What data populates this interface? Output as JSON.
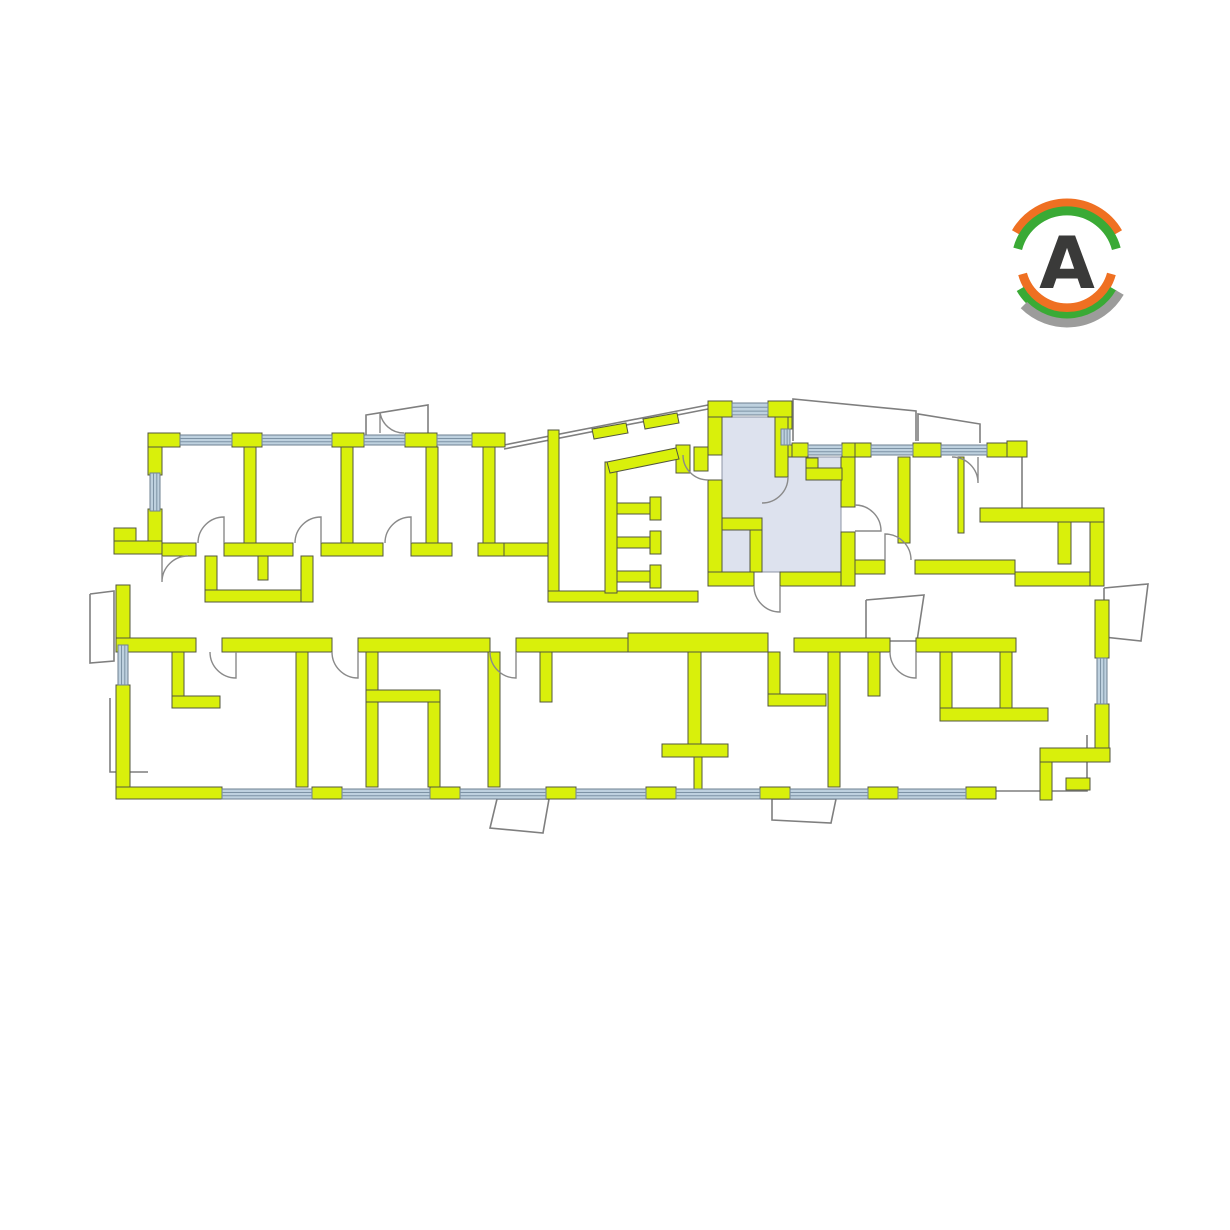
{
  "page": {
    "background": "#ffffff"
  },
  "logo": {
    "letter": "A",
    "letter_color": "#3a3a39",
    "arc_orange": "#ef7022",
    "arc_green": "#3aaa35",
    "arc_gray": "#9c9c9b"
  },
  "plan": {
    "colors": {
      "wall_fill": "#d9f00b",
      "wall_stroke": "#53573f",
      "window_fill": "#bed1df",
      "window_stroke": "#6e8090",
      "window_line": "#7d93a5",
      "highlight_fill": "#dde2ee",
      "highlight_stroke": "#8d94a5",
      "outline": "#7f7f7f",
      "door": "#8a8a8a"
    },
    "selected_unit": {
      "path": "M722,417 L775,417 L775,477 L788,477 L788,457 L841,457 L841,572 L722,572 Z"
    },
    "walls": [
      [
        148,
        433,
        32,
        14
      ],
      [
        232,
        433,
        30,
        14
      ],
      [
        332,
        433,
        32,
        14
      ],
      [
        405,
        433,
        32,
        14
      ],
      [
        472,
        433,
        33,
        14
      ],
      [
        148,
        447,
        14,
        28
      ],
      [
        148,
        509,
        14,
        32
      ],
      [
        114,
        528,
        22,
        13
      ],
      [
        114,
        541,
        48,
        13
      ],
      [
        244,
        447,
        12,
        96
      ],
      [
        341,
        447,
        12,
        96
      ],
      [
        426,
        447,
        12,
        96
      ],
      [
        483,
        447,
        12,
        96
      ],
      [
        162,
        543,
        34,
        13
      ],
      [
        224,
        543,
        69,
        13
      ],
      [
        321,
        543,
        62,
        13
      ],
      [
        411,
        543,
        41,
        13
      ],
      [
        478,
        543,
        26,
        13
      ],
      [
        504,
        543,
        44,
        13
      ],
      [
        205,
        556,
        12,
        46
      ],
      [
        205,
        590,
        108,
        12
      ],
      [
        301,
        556,
        12,
        46
      ],
      [
        258,
        556,
        10,
        24
      ],
      [
        116,
        585,
        14,
        60
      ],
      [
        116,
        685,
        14,
        114
      ],
      [
        548,
        430,
        11,
        172
      ],
      [
        548,
        591,
        150,
        11
      ],
      [
        605,
        462,
        12,
        131
      ],
      [
        617,
        503,
        42,
        11
      ],
      [
        650,
        497,
        11,
        23
      ],
      [
        617,
        537,
        42,
        11
      ],
      [
        650,
        531,
        11,
        23
      ],
      [
        617,
        571,
        42,
        11
      ],
      [
        650,
        565,
        11,
        23
      ],
      [
        676,
        445,
        14,
        28
      ],
      [
        708,
        401,
        24,
        16
      ],
      [
        768,
        401,
        24,
        16
      ],
      [
        779,
        417,
        13,
        12
      ],
      [
        779,
        445,
        13,
        12
      ],
      [
        708,
        417,
        14,
        38
      ],
      [
        708,
        480,
        14,
        92
      ],
      [
        694,
        447,
        14,
        24
      ],
      [
        708,
        572,
        46,
        14
      ],
      [
        780,
        572,
        75,
        14
      ],
      [
        841,
        457,
        14,
        50
      ],
      [
        841,
        532,
        14,
        54
      ],
      [
        792,
        443,
        16,
        14
      ],
      [
        842,
        443,
        14,
        14
      ],
      [
        775,
        417,
        13,
        60
      ],
      [
        806,
        458,
        12,
        22
      ],
      [
        806,
        468,
        36,
        12
      ],
      [
        722,
        518,
        40,
        12
      ],
      [
        750,
        530,
        12,
        42
      ],
      [
        855,
        443,
        16,
        14
      ],
      [
        913,
        443,
        28,
        14
      ],
      [
        987,
        443,
        38,
        14
      ],
      [
        1007,
        441,
        20,
        16
      ],
      [
        898,
        457,
        12,
        86
      ],
      [
        958,
        457,
        6,
        76
      ],
      [
        980,
        508,
        124,
        14
      ],
      [
        1058,
        522,
        13,
        42
      ],
      [
        915,
        560,
        100,
        14
      ],
      [
        1015,
        572,
        80,
        14
      ],
      [
        855,
        560,
        30,
        14
      ],
      [
        1090,
        522,
        14,
        64
      ],
      [
        1095,
        600,
        14,
        58
      ],
      [
        1095,
        704,
        14,
        56
      ],
      [
        1040,
        748,
        70,
        14
      ],
      [
        1040,
        762,
        12,
        38
      ],
      [
        1066,
        778,
        24,
        12
      ],
      [
        116,
        638,
        80,
        14
      ],
      [
        222,
        638,
        110,
        14
      ],
      [
        358,
        638,
        132,
        14
      ],
      [
        516,
        638,
        112,
        14
      ],
      [
        628,
        633,
        140,
        19
      ],
      [
        794,
        638,
        96,
        14
      ],
      [
        916,
        638,
        100,
        14
      ],
      [
        172,
        652,
        12,
        56
      ],
      [
        172,
        696,
        48,
        12
      ],
      [
        296,
        652,
        12,
        135
      ],
      [
        366,
        652,
        12,
        135
      ],
      [
        366,
        690,
        74,
        12
      ],
      [
        428,
        702,
        12,
        85
      ],
      [
        488,
        652,
        12,
        135
      ],
      [
        540,
        652,
        12,
        50
      ],
      [
        688,
        652,
        13,
        104
      ],
      [
        662,
        744,
        66,
        13
      ],
      [
        694,
        757,
        8,
        32
      ],
      [
        768,
        652,
        12,
        50
      ],
      [
        768,
        694,
        58,
        12
      ],
      [
        828,
        652,
        12,
        135
      ],
      [
        868,
        652,
        12,
        44
      ],
      [
        940,
        652,
        12,
        68
      ],
      [
        940,
        708,
        108,
        13
      ],
      [
        1000,
        652,
        12,
        56
      ],
      [
        116,
        787,
        106,
        12
      ],
      [
        312,
        787,
        30,
        12
      ],
      [
        430,
        787,
        30,
        12
      ],
      [
        546,
        787,
        30,
        12
      ],
      [
        646,
        787,
        30,
        12
      ],
      [
        760,
        787,
        30,
        12
      ],
      [
        868,
        787,
        30,
        12
      ],
      [
        966,
        787,
        30,
        12
      ]
    ],
    "wall_polys": [
      "592,429 626,423 628,433 594,439",
      "643,419 677,413 679,423 645,429",
      "607,462 676,448 679,459 610,473"
    ],
    "windows": [
      [
        180,
        435,
        52,
        10
      ],
      [
        262,
        435,
        70,
        10
      ],
      [
        364,
        435,
        41,
        10
      ],
      [
        437,
        435,
        35,
        10
      ],
      [
        732,
        403,
        36,
        12
      ],
      [
        808,
        445,
        34,
        10
      ],
      [
        871,
        445,
        42,
        10
      ],
      [
        941,
        445,
        46,
        10
      ],
      [
        150,
        473,
        10,
        38
      ],
      [
        118,
        645,
        10,
        40
      ],
      [
        781,
        429,
        9,
        16
      ],
      [
        1097,
        658,
        10,
        46
      ],
      [
        222,
        789,
        90,
        10
      ],
      [
        342,
        789,
        88,
        10
      ],
      [
        460,
        789,
        86,
        10
      ],
      [
        576,
        789,
        70,
        10
      ],
      [
        676,
        789,
        84,
        10
      ],
      [
        790,
        789,
        78,
        10
      ],
      [
        898,
        789,
        68,
        10
      ]
    ],
    "balcony_outlines": [
      "366,436 366,415 428,405 428,436",
      "793,441 793,399 916,411 916,441",
      "918,441 918,414 980,424 980,443",
      "90,594 114,591 114,661 90,663 90,594",
      "497,799 549,799 543,833 490,828 497,799",
      "772,799 836,799 831,823 772,820 772,799",
      "1104,588 1148,584 1141,641 1104,637 1104,588",
      "866,600 924,595 917,641 866,641 866,600",
      "996,791 1087,791 1087,735",
      "110,698 110,772 148,772"
    ],
    "facade_lines": [
      [
        504,
        445,
        708,
        405
      ],
      [
        504,
        449,
        708,
        409
      ],
      [
        1022,
        457,
        1022,
        508
      ],
      [
        1102,
        522,
        1102,
        572
      ]
    ],
    "doors": [
      "M224,543 L224,517 A26,26 0 0 0 198,543",
      "M321,543 L321,517 A26,26 0 0 0 295,543",
      "M411,543 L411,517 A26,26 0 0 0 385,543",
      "M162,556 L162,582 A26,26 0 0 1 188,556",
      "M236,652 L236,678 A26,26 0 0 1 210,652",
      "M358,652 L358,678 A26,26 0 0 1 332,652",
      "M516,652 L516,678 A26,26 0 0 1 490,652",
      "M916,652 L916,678 A26,26 0 0 1 890,652",
      "M780,586 L780,612 A26,26 0 0 1 754,586",
      "M855,531 L881,531 A26,26 0 0 0 855,505",
      "M788,477 A26,26 0 0 1 762,503",
      "M978,457 L978,483 A26,26 0 0 0 952,457",
      "M885,560 L885,534 A26,26 0 0 1 911,560",
      "M708,480 A25,25 0 0 1 683,455",
      "M380,433 L380,412 A24,24 0 0 0 404,433"
    ]
  }
}
